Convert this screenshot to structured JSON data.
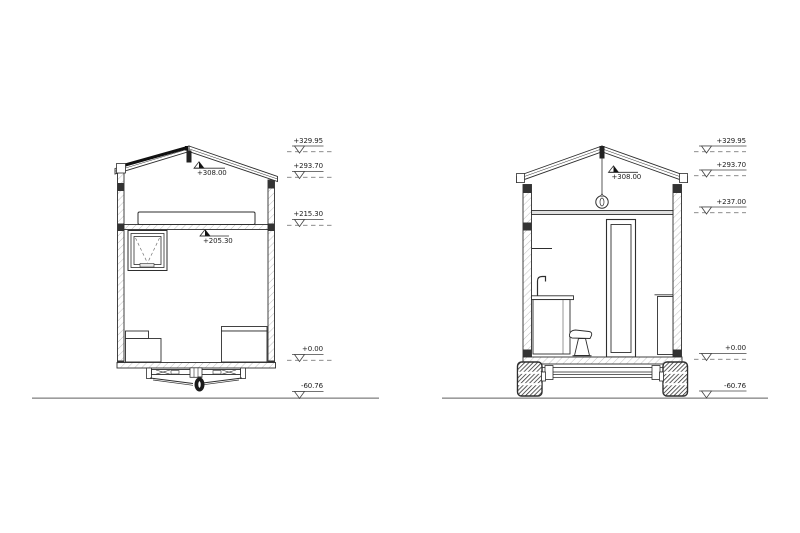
{
  "drawing": {
    "type": "architectural-cross-sections",
    "subject": "tiny house on trailer, two sections"
  },
  "left_section": {
    "name": "section-front-with-drawbar",
    "levels": {
      "ridge": "+308.00",
      "loft": "+205.30"
    },
    "markers": [
      "+329.95",
      "+293.70",
      "+215.30",
      "+0.00",
      "-60.76"
    ]
  },
  "right_section": {
    "name": "section-rear-with-axle-wheels",
    "levels": {
      "ridge": "+308.00"
    },
    "markers": [
      "+329.95",
      "+293.70",
      "+237.00",
      "+0.00",
      "-60.76"
    ]
  },
  "colors": {
    "line": "#2e2e2e",
    "dark_fill": "#1a1a1a",
    "hatch": "#c0c0c0",
    "ground": "#9c9c9c",
    "text": "#1c1c1c"
  }
}
